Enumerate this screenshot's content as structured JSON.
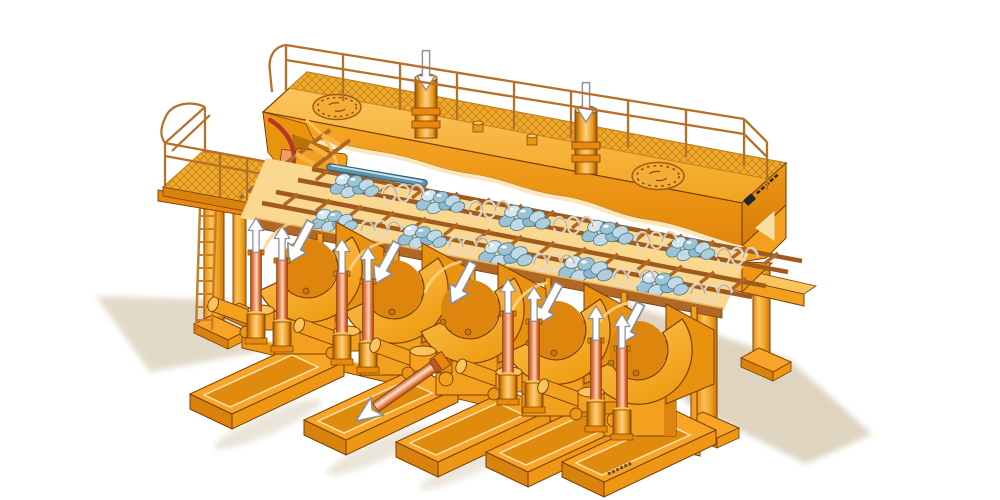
{
  "scene": {
    "type": "technical-illustration",
    "description": "Isometric cutaway illustration of a large orange hydraulic machine: a top service deck with mesh walkway, guard railings, two manhole covers and two accumulator cylinders marked with white down arrows; a left access platform with stairs, ladder and railing; a central rack of two ladder frames holding shiny blue-grey workpiece clusters and coil springs; and five hydraulic drive units on orange base skids, four with paired lift cylinders marked with white up arrows, the middle unit showing an extended piston rod with a large arrow pointing to the lower left.",
    "background_color": "#ffffff"
  },
  "palette": {
    "body_orange": "#F7A427",
    "body_light": "#FBC45C",
    "body_dark": "#E8890C",
    "body_deep": "#D9820D",
    "outline_brown": "#7A3F05",
    "rail_brown": "#B5702A",
    "rack_rail_brown": "#A05A1E",
    "mesh_yellow": "#EFA92B",
    "mesh_line": "#C8831A",
    "cream_highlight": "#FCE8C0",
    "rod_salmon": "#F49B6A",
    "rod_highlight": "#FFE3C8",
    "workpiece_blue_light": "#D6E6EE",
    "workpiece_blue": "#8FB9CC",
    "workpiece_blue_dark": "#4A7E96",
    "cut_edge_red": "#B5372A",
    "shadow_beige": "#D9CDB6",
    "arrow_white": "#FFFFFF",
    "arrow_outline": "#8A8F98"
  },
  "machine": {
    "top_deck": {
      "manhole_covers": 2,
      "deck_pins": 2,
      "mesh_walkway": true,
      "guard_railing": true
    },
    "accumulator_cylinders": {
      "count": 2,
      "arrow_direction": "down"
    },
    "left_access": {
      "side_platform": true,
      "stairs": true,
      "ladder": true,
      "support_columns": 2
    },
    "work_rack": {
      "ladder_frames": 2,
      "workpiece_clusters": 10,
      "coil_springs": 10,
      "workpiece_bars": 1,
      "frame_posts": 6
    },
    "drive_units": {
      "count": 5,
      "housing_arrow_direction": "down-left",
      "lift_cylinders_per_unit": 2,
      "lift_arrow_direction": "up",
      "units_with_lift_cylinders": [
        1,
        2,
        4,
        5
      ],
      "extended_piston_unit": 3,
      "piston_arrow_direction": "down-left",
      "base_skids": 5
    },
    "right_support": {
      "legs": 2,
      "table_frame": true
    }
  },
  "markings": {
    "manufacturer_logo": "dark emblem with small wordmark on right end plate (illegible)",
    "drawing_number": "tiny code marking on front base skid (illegible)"
  }
}
